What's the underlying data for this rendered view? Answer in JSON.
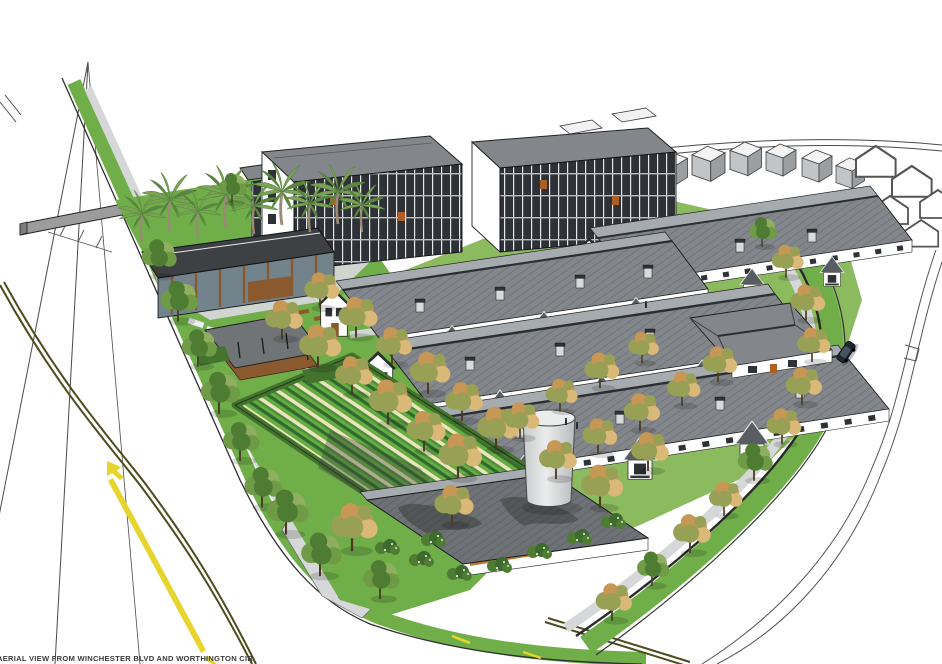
{
  "caption": {
    "text": "AERIAL VIEW FROM WINCHESTER BLVD AND WORTHINGTON CIR"
  },
  "palette": {
    "bg": "#ffffff",
    "ink": "#1f1f1f",
    "road-line": "#4a4a4a",
    "olive-line": "#4c4c1c",
    "road-yellow": "#e7d42e",
    "concrete": "#d6d7d8",
    "concrete-dark": "#bfc1c3",
    "roof": "#83878b",
    "roof-dark": "#595d61",
    "roof-light": "#a6abaf",
    "ridge": "#2c2f32",
    "wall": "#ffffff",
    "win": "#2e3236",
    "mull": "#e6e9ea",
    "wood": "#8a5a2e",
    "wood-bright": "#c07a30",
    "accent-orange": "#ad5f25",
    "glass": "#72838c",
    "neighbor-wall": "#c2c5c7",
    "neighbor-side": "#9b9fa2",
    "gray-wall": "#9c9c9c",
    "palm": "#7aa355",
    "palm-dark": "#5a8540",
    "trunk": "#4a3a24",
    "palm-trunk": "#9a8a76",
    "tree-olive": "#97a055",
    "tree-orange": "#c69755",
    "tree-tan": "#d9b878",
    "tree-green": "#6f9a46",
    "tree-green2": "#8fae5f",
    "tree-green-dark": "#4e7c33",
    "lawn": "#6fae49",
    "lawn2": "#8cba5f",
    "hedge": "#44732f",
    "garden-dark": "#2e6a2e",
    "garden-green": "#67ab43",
    "garden-green2": "#4c8f3c",
    "garden-cream": "#ece4ba",
    "cyl": "#c9cacc",
    "cyl-hi": "#ebecec",
    "car": "#1b2733",
    "caption-color": "#3b3b3b"
  }
}
